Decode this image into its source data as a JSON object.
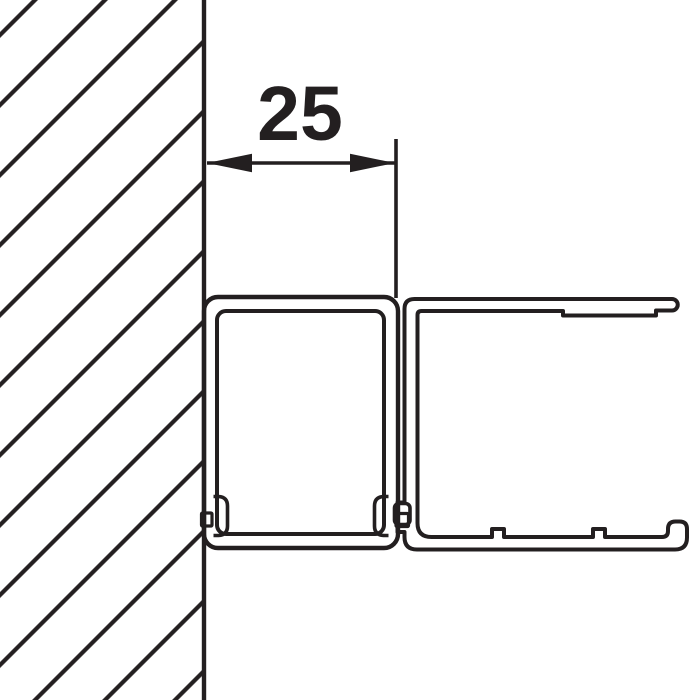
{
  "diagram": {
    "dimension_label": "25",
    "colors": {
      "line": "#231f20",
      "profile_fill": "#d8d9da",
      "background": "#ffffff"
    }
  }
}
